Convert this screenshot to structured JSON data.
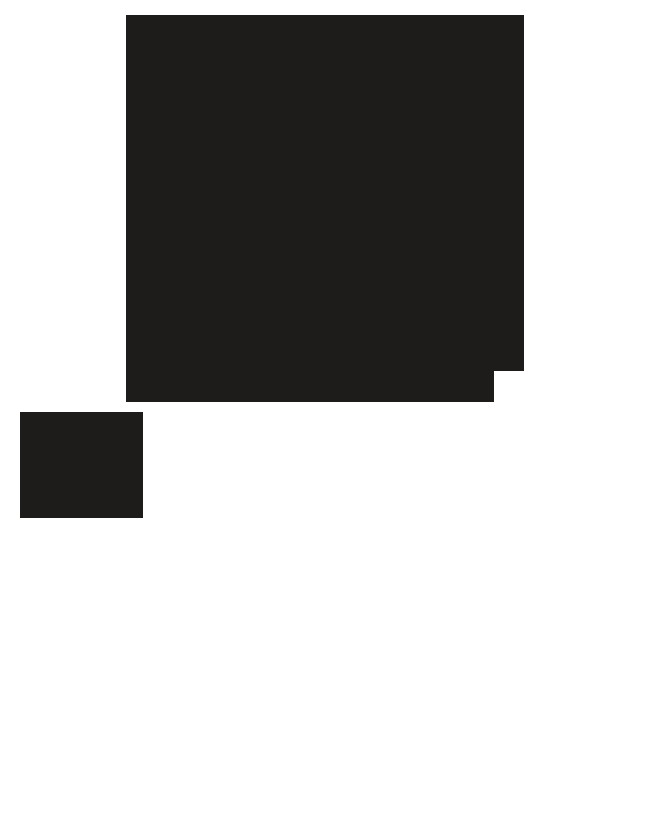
{
  "page": {
    "background_color": "#ffffff"
  },
  "content": {
    "large_block": {
      "description": "large dark rectangular block with stepped bottom-right corner",
      "color": "#1d1c1b",
      "text": ""
    },
    "small_block": {
      "description": "small dark rectangular block below left edge of large block",
      "color": "#1d1c1b",
      "text": ""
    }
  }
}
